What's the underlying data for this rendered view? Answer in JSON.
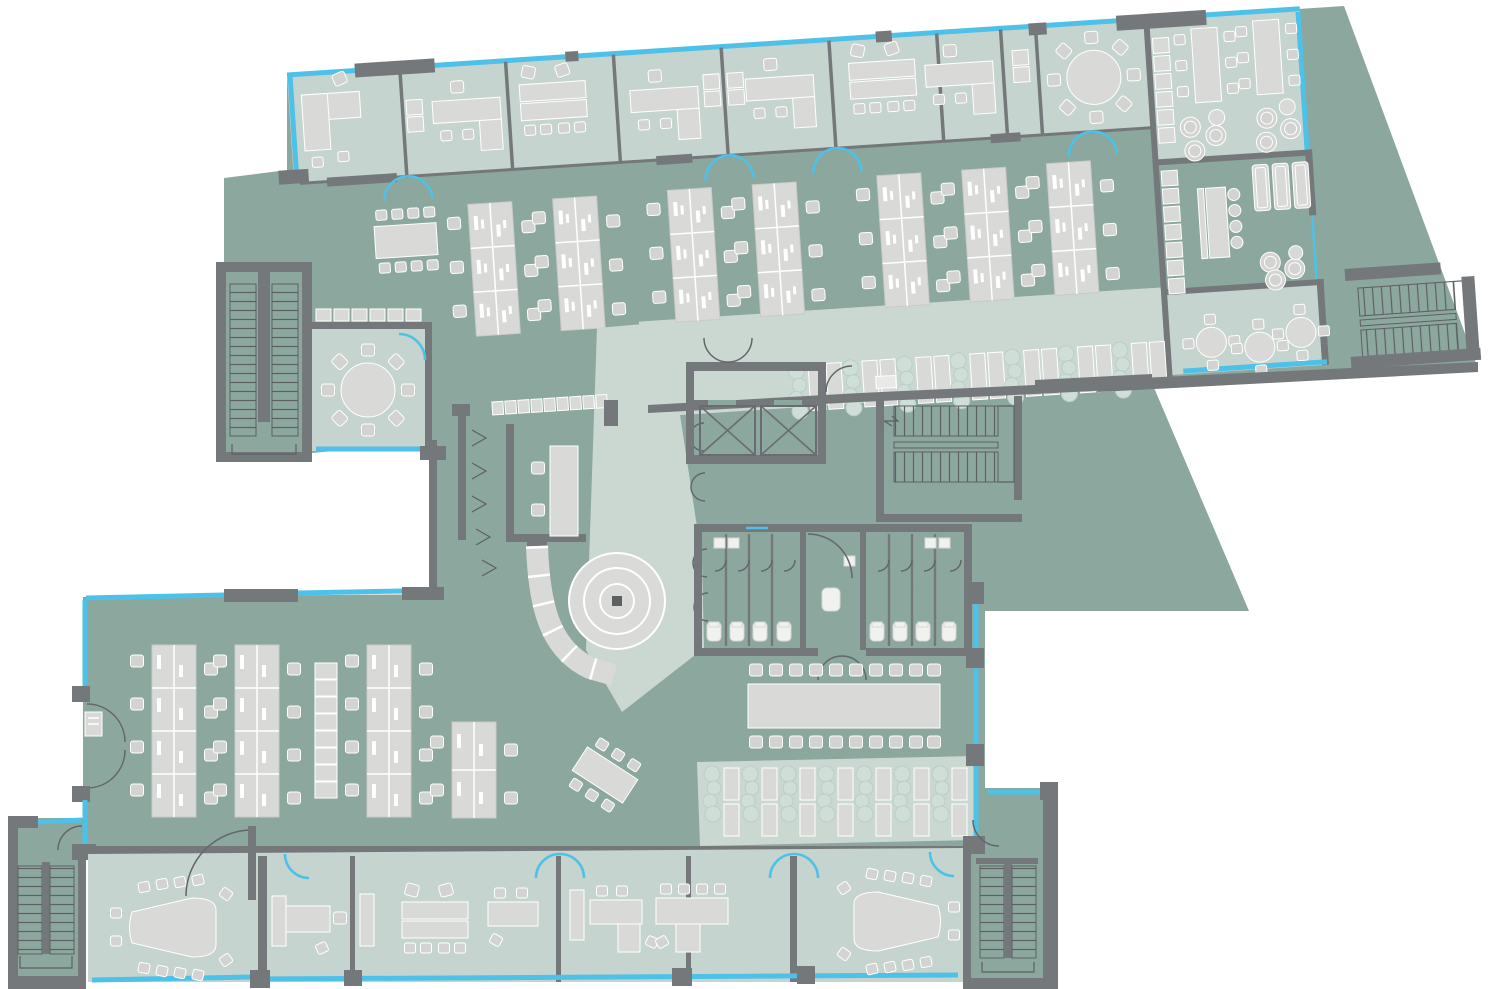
{
  "diagram": {
    "kind": "office floor plan",
    "orientation_deg": -3.74,
    "inventory": {
      "private_offices_top_band": 8,
      "open_plan_benches_upper": 7,
      "open_plan_benches_lower": 4,
      "meeting_round_table_rooms": 2,
      "trapezoid_conference_rooms": 2,
      "long_communal_table_seats": 20,
      "elevators": 2,
      "stairwells": 5,
      "restroom_stalls": 8,
      "accessible_wc": 1,
      "lounge_areas": 2,
      "cafe_round_tables": 3,
      "locker_runs": 4,
      "reception_desk": 1,
      "spiral_feature": 1,
      "terraces": 2
    }
  },
  "colors": {
    "bg": "#ffffff",
    "floor_dark": "#8ca79e",
    "floor_light": "#c5d4ce",
    "floor_light2": "#cbd8d2",
    "wall": "#75787b",
    "glass": "#4ec1e8",
    "furn": "#d9d9d7",
    "plant": "#cfdfd8",
    "stair": "#5d6063"
  }
}
